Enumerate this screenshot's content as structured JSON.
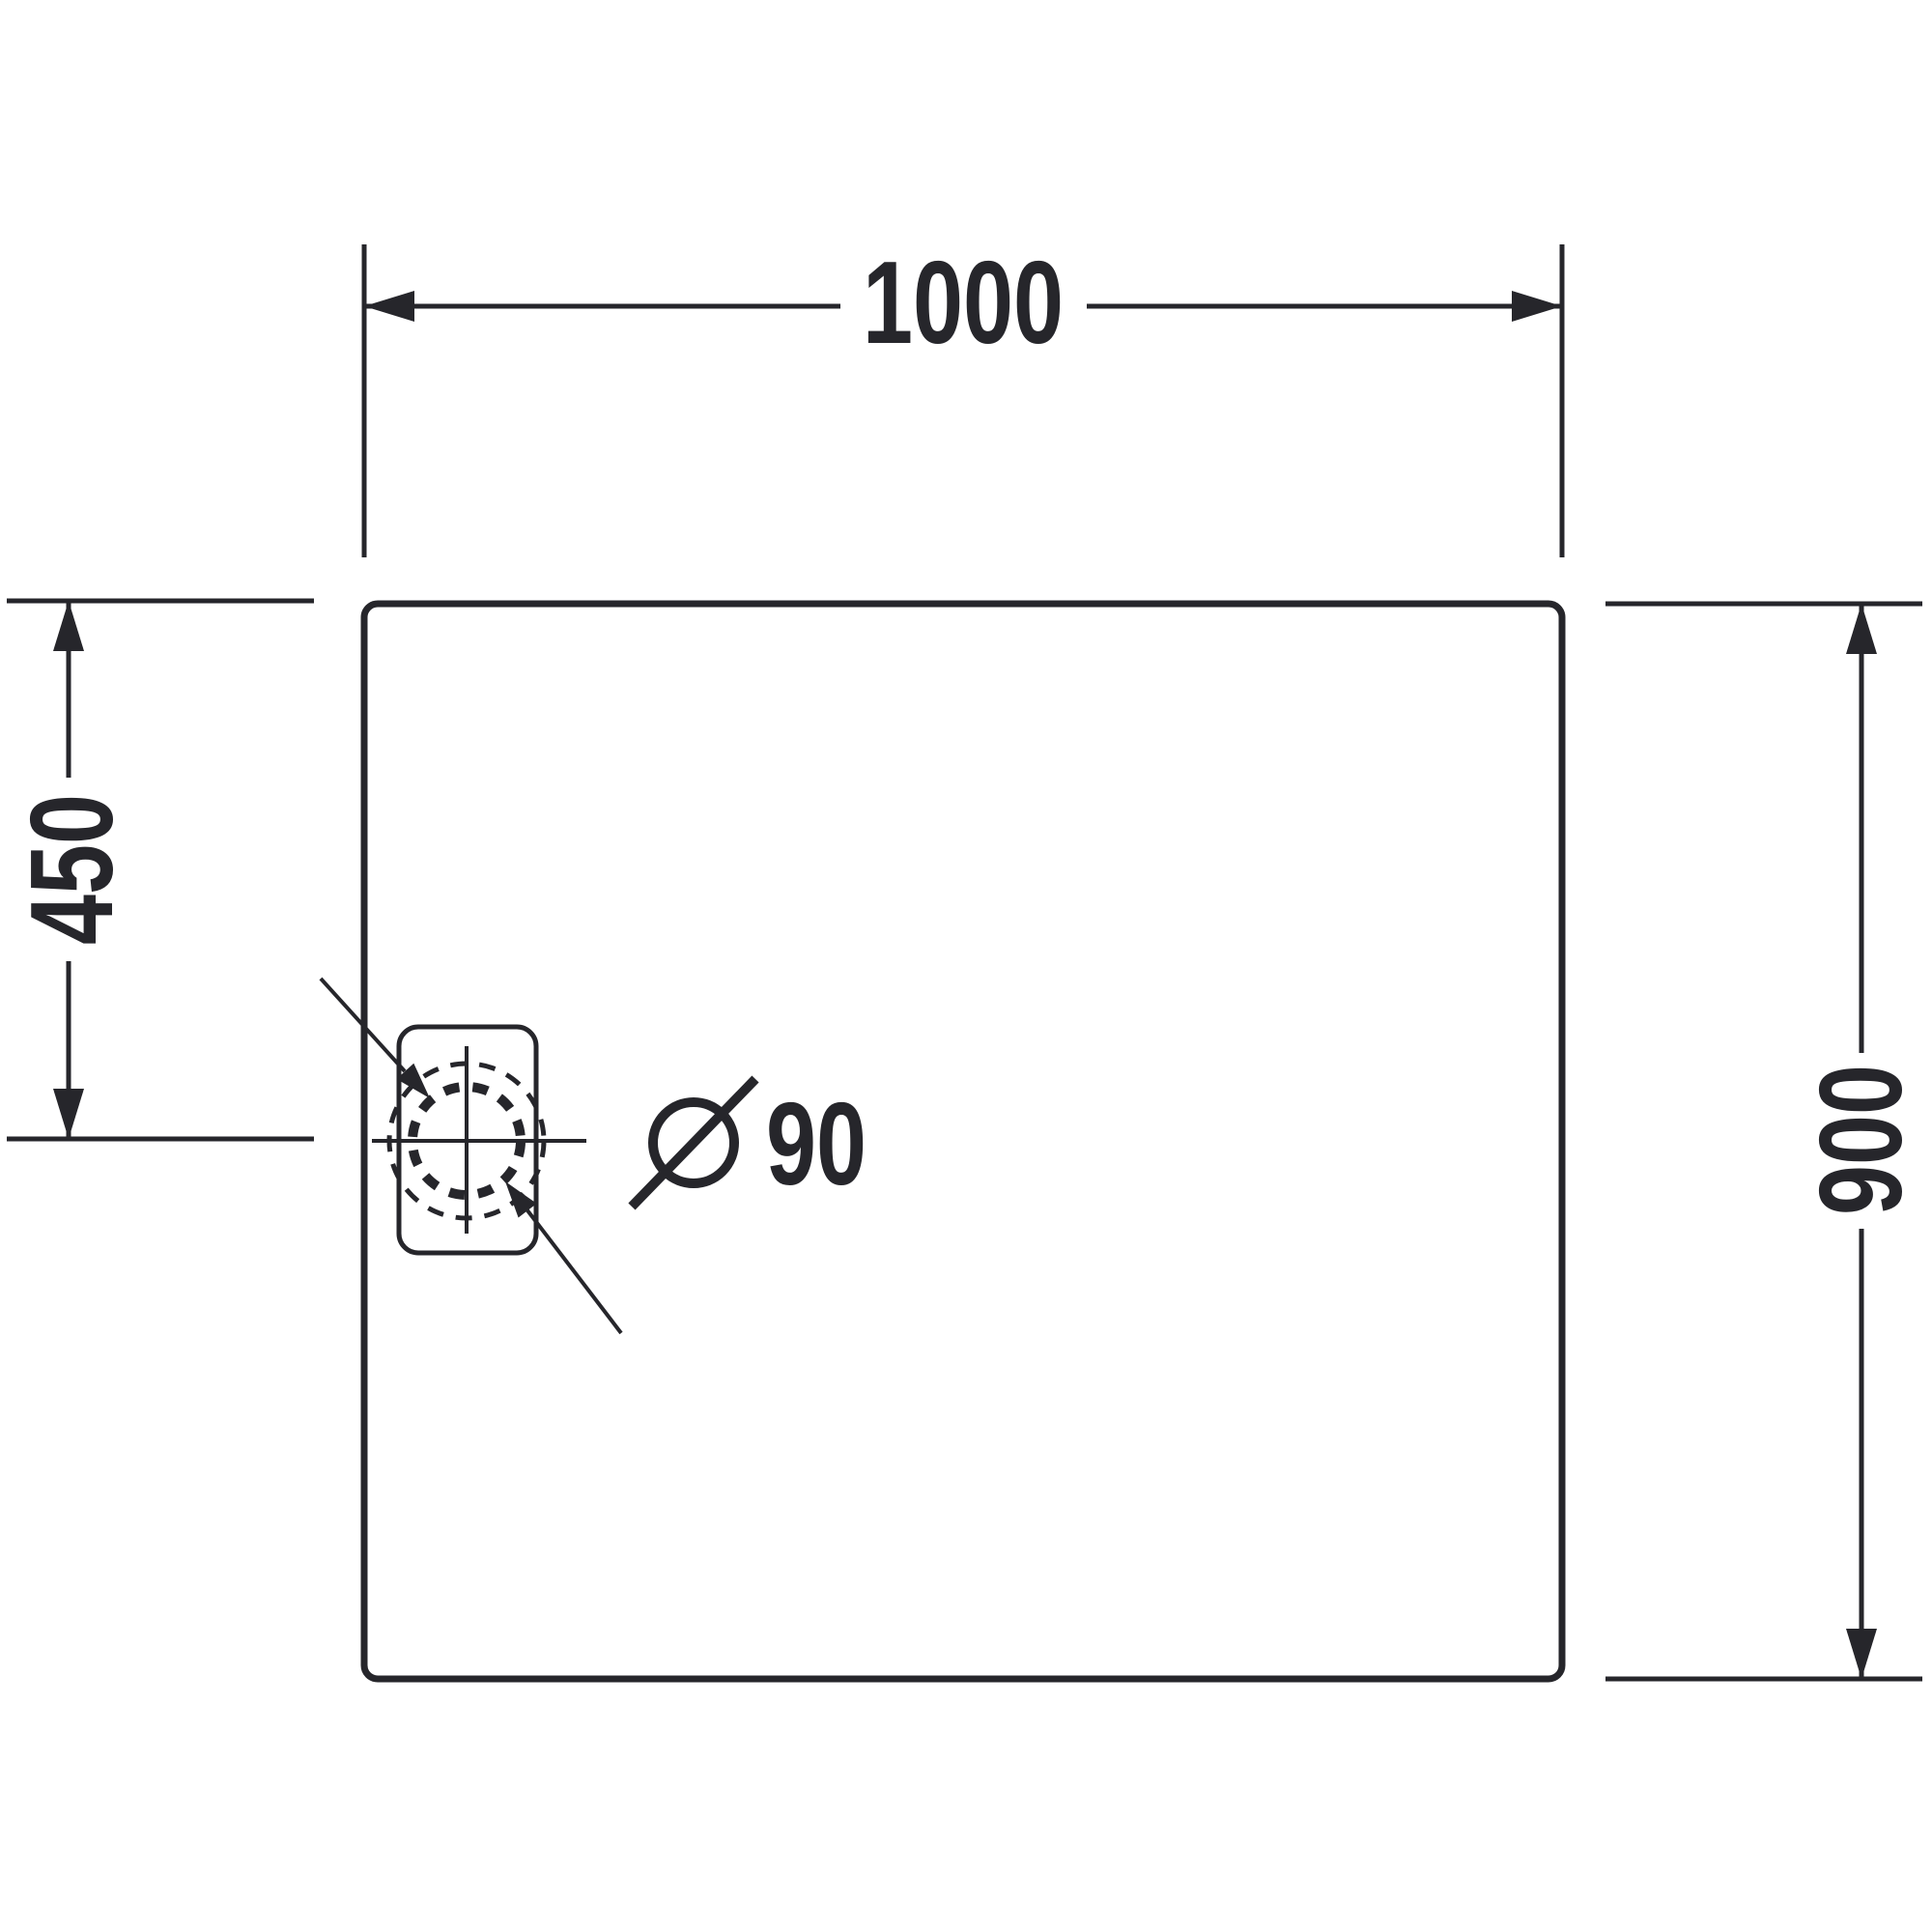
{
  "drawing": {
    "type": "technical-dimension-drawing",
    "subject": "rectangular shower tray with corner drain, top view"
  },
  "dimensions": {
    "width": {
      "label": "1000"
    },
    "drain_offset": {
      "label": "450"
    },
    "depth": {
      "label": "900"
    },
    "drain_diameter": {
      "symbol": "Ø",
      "label": "90",
      "full_label": "Ø 90"
    }
  },
  "colors": {
    "line": "#26262b",
    "background": "#ffffff"
  }
}
